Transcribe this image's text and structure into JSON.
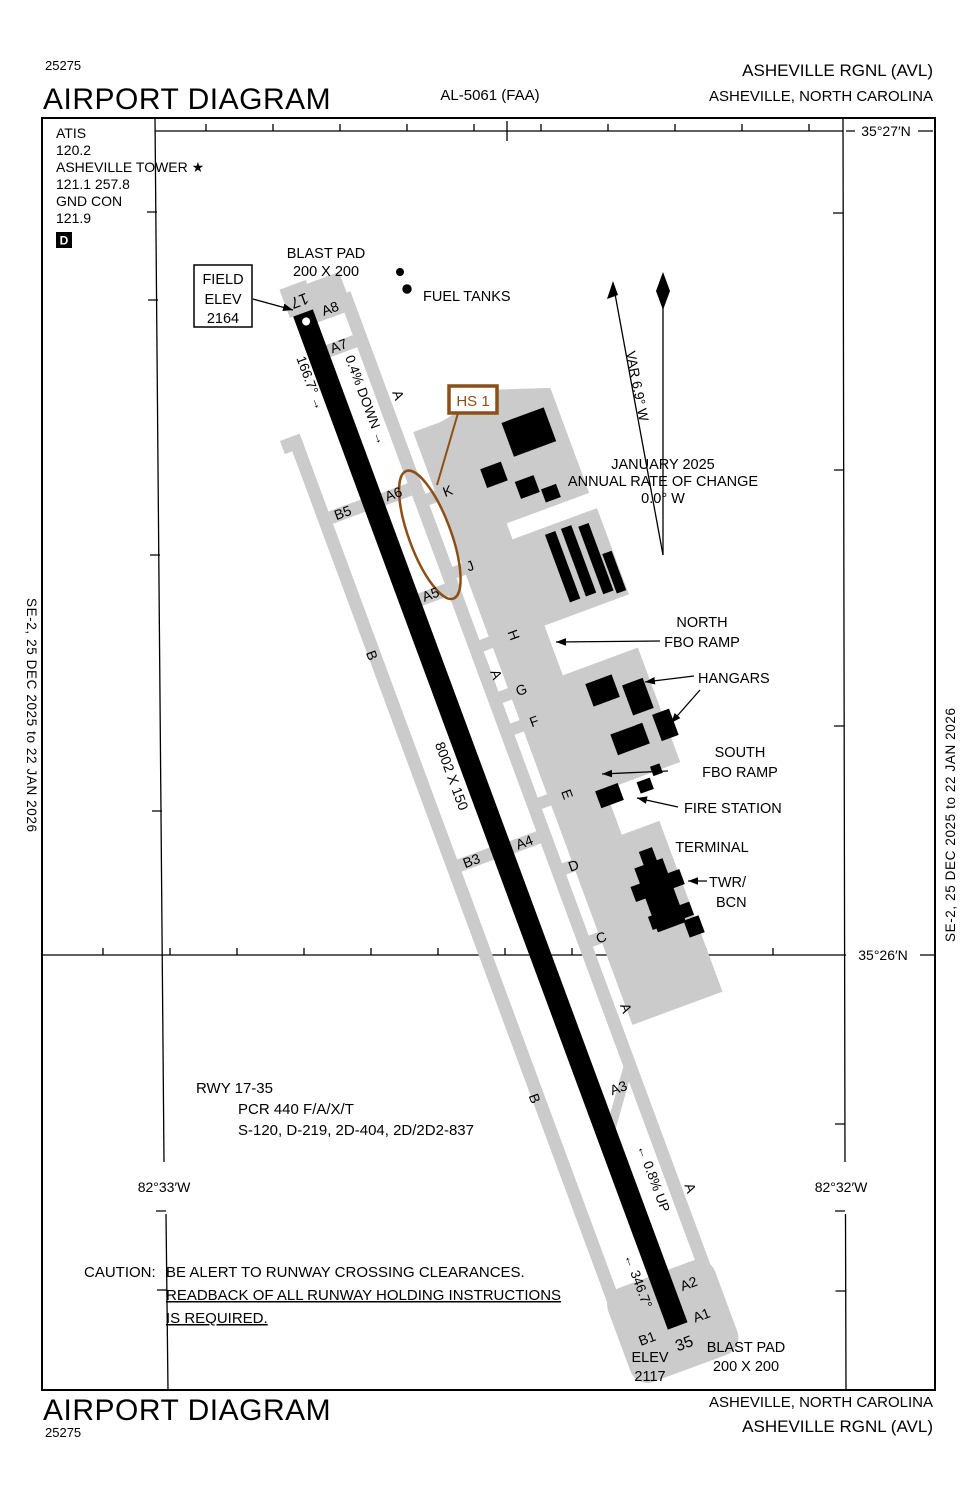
{
  "header": {
    "code": "25275",
    "title": "AIRPORT DIAGRAM",
    "al": "AL-5061 (FAA)",
    "airport": "ASHEVILLE RGNL  (AVL)",
    "city": "ASHEVILLE, NORTH CAROLINA"
  },
  "footer": {
    "title": "AIRPORT DIAGRAM",
    "code": "25275",
    "city": "ASHEVILLE, NORTH CAROLINA",
    "airport": "ASHEVILLE RGNL  (AVL)"
  },
  "comm": {
    "atis_label": "ATIS",
    "atis_freq": "120.2",
    "twr_label": "ASHEVILLE TOWER ★",
    "twr_freq": "121.1  257.8",
    "gnd_label": "GND CON",
    "gnd_freq": "121.9",
    "d_box": "D"
  },
  "margins": {
    "left": "SE-2,  25 DEC 2025  to  22 JAN 2026",
    "right": "SE-2,  25 DEC 2025  to  22 JAN 2026"
  },
  "coords": {
    "lat_top": "35°27′N",
    "lat_mid": "35°26′N",
    "lon_left": "82°33′W",
    "lon_right": "82°32′W"
  },
  "compass": {
    "var_label": "VAR 6.9° W",
    "date": "JANUARY 2025",
    "rate": "ANNUAL RATE OF CHANGE",
    "value": "0.0° W"
  },
  "runway": {
    "id_17": "17",
    "id_35": "35",
    "hdg_17_text": "166.7° →",
    "hdg_35_text": "← 346.7°",
    "dims": "8002 X 150",
    "grad_north": "0.4% DOWN →",
    "grad_south": "← 0.8% UP",
    "rwy_label": "RWY 17-35",
    "pcr": "PCR 440 F/A/X/T",
    "strength": "S-120, D-219, 2D-404, 2D/2D2-837",
    "elev17_l1": "FIELD",
    "elev17_l2": "ELEV",
    "elev17_l3": "2164",
    "elev35_l1": "ELEV",
    "elev35_l2": "2117",
    "blast_l1": "BLAST PAD",
    "blast_l2": "200 X 200"
  },
  "hotspot": {
    "label": "HS 1"
  },
  "features": {
    "fuel": "FUEL TANKS",
    "north_ramp_l1": "NORTH",
    "north_ramp_l2": "FBO RAMP",
    "hangars": "HANGARS",
    "south_ramp_l1": "SOUTH",
    "south_ramp_l2": "FBO RAMP",
    "fire": "FIRE STATION",
    "terminal": "TERMINAL",
    "twr_l1": "TWR/",
    "twr_l2": "BCN"
  },
  "caution": {
    "l1": "CAUTION:",
    "l2": "BE ALERT TO RUNWAY CROSSING CLEARANCES.",
    "l3": "READBACK OF ALL RUNWAY HOLDING INSTRUCTIONS",
    "l4": "IS REQUIRED."
  },
  "taxiways": {
    "a8": "A8",
    "a7": "A7",
    "a6": "A6",
    "a5": "A5",
    "a4": "A4",
    "a3": "A3",
    "a2": "A2",
    "a1": "A1",
    "b5": "B5",
    "b3": "B3",
    "b1": "B1",
    "k": "K",
    "j": "J",
    "h": "H",
    "g": "G",
    "f": "F",
    "e": "E",
    "d": "D",
    "c": "C",
    "a": "A",
    "b": "B"
  },
  "colors": {
    "pavement": "#cbcbcb",
    "hotspot": "#8c4f17"
  }
}
